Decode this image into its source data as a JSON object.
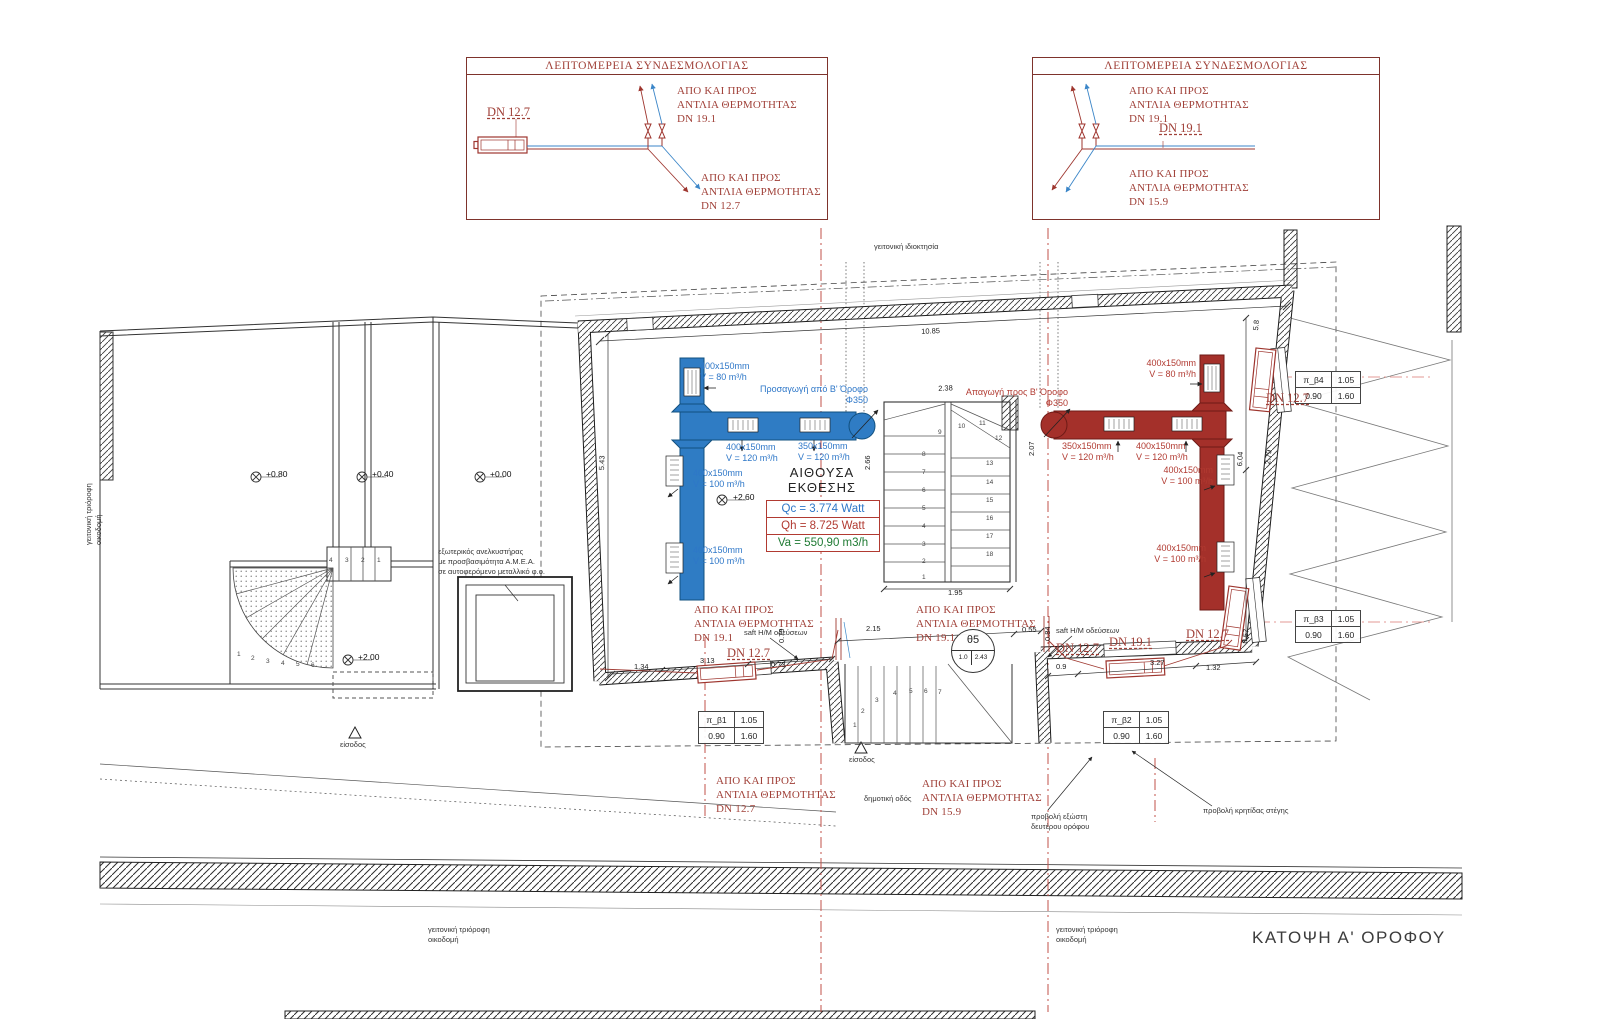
{
  "title": "ΚΑΤΟΨΗ Α' ΟΡΟΦΟΥ",
  "detail_left": {
    "title": "ΛΕΠΤΟΜΕΡΕΙΑ ΣΥΝΔΕΣΜΟΛΟΓΙΑΣ",
    "top_label": "ΑΠΟ ΚΑΙ ΠΡΟΣ\nΑΝΤΛΙΑ ΘΕΡΜΟΤΗΤΑΣ\nDN 19.1",
    "bottom_label": "ΑΠΟ ΚΑΙ ΠΡΟΣ\nΑΝΤΛΙΑ ΘΕΡΜΟΤΗΤΑΣ\nDN 12.7"
  },
  "detail_right": {
    "title": "ΛΕΠΤΟΜΕΡΕΙΑ ΣΥΝΔΕΣΜΟΛΟΓΙΑΣ",
    "top_label": "ΑΠΟ ΚΑΙ ΠΡΟΣ\nΑΝΤΛΙΑ ΘΕΡΜΟΤΗΤΑΣ\nDN 19.1",
    "bottom_label": "ΑΠΟ ΚΑΙ ΠΡΟΣ\n ΑΝΤΛΙΑ ΘΕΡΜΟΤΗΤΑΣ\nDN 15.9"
  },
  "room": {
    "name": "ΑΙΘΟΥΣΑ\nΕΚΘΕΣΗΣ",
    "qc": "Qc = 3.774 Watt",
    "qh": "Qh = 8.725 Watt",
    "va": "Va = 550,90 m3/h"
  },
  "tags": {
    "pb1": {
      "name": "π_β1",
      "w": "1.05",
      "h1": "0.90",
      "h2": "1.60"
    },
    "pb2": {
      "name": "π_β2",
      "w": "1.05",
      "h1": "0.90",
      "h2": "1.60"
    },
    "pb3": {
      "name": "π_β3",
      "w": "1.05",
      "h1": "0.90",
      "h2": "1.60"
    },
    "pb4": {
      "name": "π_β4",
      "w": "1.05",
      "h1": "0.90",
      "h2": "1.60"
    },
    "theta": {
      "name": "θ5",
      "a": "1.0",
      "b": "2.43"
    }
  },
  "colors": {
    "supply_duct": "#2F7CC4",
    "return_duct": "#A4302A",
    "pipe_red": "#9E352E",
    "pipe_blue": "#3B86C8",
    "annotation_red": "#A04038",
    "centerline_red": "#C2514A"
  },
  "annotations": [
    {
      "n": "detail-left-dn",
      "t": "DN 12.7",
      "x": 487,
      "y": 106,
      "cls": "rtxt2"
    },
    {
      "n": "detail-right-dn",
      "t": "DN 19.1",
      "x": 1159,
      "y": 122,
      "cls": "rtxt2"
    },
    {
      "n": "duct-supply-branch-80",
      "t": "400x150mm\nV = 80 m³/h",
      "x": 700,
      "y": 361,
      "cls": "btxt"
    },
    {
      "n": "duct-supply-riser",
      "t": "Προσαγωγή από Β' Όροφο\nΦ350",
      "x": 750,
      "y": 384,
      "cls": "btxt ra",
      "w": 118
    },
    {
      "n": "duct-supply-120a",
      "t": "400x150mm\nV = 120 m³/h",
      "x": 726,
      "y": 442,
      "cls": "btxt"
    },
    {
      "n": "duct-supply-120b",
      "t": "350x150mm\nV = 120 m³/h",
      "x": 798,
      "y": 441,
      "cls": "btxt"
    },
    {
      "n": "duct-supply-100a",
      "t": "400x150mm\nV = 100 m³/h",
      "x": 693,
      "y": 468,
      "cls": "btxt"
    },
    {
      "n": "duct-supply-100b",
      "t": "400x150mm\nV = 100 m³/h",
      "x": 693,
      "y": 545,
      "cls": "btxt"
    },
    {
      "n": "duct-return-branch-80",
      "t": "400x150mm\nV = 80 m³/h",
      "x": 1128,
      "y": 358,
      "cls": "rdtxt ra",
      "w": 68
    },
    {
      "n": "duct-return-riser",
      "t": "Απαγωγή προς Β' Όροφο\nΦ350",
      "x": 950,
      "y": 387,
      "cls": "rdtxt ra",
      "w": 118
    },
    {
      "n": "duct-return-120a",
      "t": "350x150mm\nV = 120 m³/h",
      "x": 1062,
      "y": 441,
      "cls": "rdtxt"
    },
    {
      "n": "duct-return-120b",
      "t": "400x150mm\nV = 120 m³/h",
      "x": 1136,
      "y": 441,
      "cls": "rdtxt"
    },
    {
      "n": "duct-return-100a",
      "t": "400x150mm\nV = 100 m³/h",
      "x": 1145,
      "y": 465,
      "cls": "rdtxt ra",
      "w": 68
    },
    {
      "n": "duct-return-100b",
      "t": "400x150mm\nV = 100 m³/h",
      "x": 1138,
      "y": 543,
      "cls": "rdtxt ra",
      "w": 68
    },
    {
      "n": "hp-label-inside-left",
      "t": "ΑΠΟ ΚΑΙ ΠΡΟΣ\nΑΝΤΛΙΑ ΘΕΡΜΟΤΗΤΑΣ\nDN 19.1",
      "x": 694,
      "y": 604,
      "cls": "rtxt"
    },
    {
      "n": "hp-label-inside-right",
      "t": "ΑΠΟ ΚΑΙ ΠΡΟΣ\nΑΝΤΛΙΑ ΘΕΡΜΟΤΗΤΑΣ\nDN 19.1",
      "x": 916,
      "y": 604,
      "cls": "rtxt"
    },
    {
      "n": "hp-label-outside-left",
      "t": "ΑΠΟ ΚΑΙ ΠΡΟΣ\nΑΝΤΛΙΑ ΘΕΡΜΟΤΗΤΑΣ\nDN 12.7",
      "x": 716,
      "y": 775,
      "cls": "rtxt"
    },
    {
      "n": "hp-label-outside-right",
      "t": "ΑΠΟ ΚΑΙ ΠΡΟΣ\nΑΝΤΛΙΑ ΘΕΡΜΟΤΗΤΑΣ\nDN 15.9",
      "x": 922,
      "y": 778,
      "cls": "rtxt"
    },
    {
      "n": "dn-tag-1",
      "t": "DN 12.7",
      "x": 727,
      "y": 647,
      "cls": "rtxt2"
    },
    {
      "n": "dn-tag-2",
      "t": "DN 12.7",
      "x": 1056,
      "y": 642,
      "cls": "rtxt2"
    },
    {
      "n": "dn-tag-3",
      "t": "DN 19.1",
      "x": 1109,
      "y": 636,
      "cls": "rtxt2"
    },
    {
      "n": "dn-tag-4",
      "t": "DN 12.7",
      "x": 1186,
      "y": 628,
      "cls": "rtxt2"
    },
    {
      "n": "dn-tag-5",
      "t": "DN 12.7",
      "x": 1266,
      "y": 392,
      "cls": "rtxt2"
    },
    {
      "n": "shaft-label-left",
      "t": "saft H/M οδεύσεων",
      "x": 744,
      "y": 628,
      "cls": "ktxt"
    },
    {
      "n": "shaft-label-right",
      "t": "saft H/M οδεύσεων",
      "x": 1056,
      "y": 626,
      "cls": "ktxt"
    },
    {
      "n": "site-neighbor-property",
      "t": "γειτονική ιδιοκτησία",
      "x": 874,
      "y": 242,
      "cls": "ktxt"
    },
    {
      "n": "site-municipal-road",
      "t": "δημοτική οδός",
      "x": 864,
      "y": 794,
      "cls": "ktxt"
    },
    {
      "n": "entrance-label-main",
      "t": "είσοδος",
      "x": 849,
      "y": 755,
      "cls": "ktxt"
    },
    {
      "n": "entrance-label-left",
      "t": "είσοδος",
      "x": 340,
      "y": 740,
      "cls": "ktxt"
    },
    {
      "n": "projection-balcony",
      "t": "προβολή εξώστη\nδευτέρου ορόφου",
      "x": 1031,
      "y": 812,
      "cls": "ktxt"
    },
    {
      "n": "projection-roof",
      "t": "προβολή κρητίδας στέγης",
      "x": 1203,
      "y": 806,
      "cls": "ktxt"
    },
    {
      "n": "neighbor-building-bottom-left",
      "t": "γειτονική τριόροφη\nοικοδομή",
      "x": 428,
      "y": 925,
      "cls": "ktxt"
    },
    {
      "n": "neighbor-building-bottom-center",
      "t": "γειτονική τριόροφη\nοικοδομή",
      "x": 1056,
      "y": 925,
      "cls": "ktxt"
    },
    {
      "n": "neighbor-building-left",
      "t": "γειτονική τριόροφη\nοικοδομή",
      "x": 84,
      "y": 545,
      "cls": "ktxt",
      "r": -90
    },
    {
      "n": "lift-note",
      "t": "εξωτερικός ανελκυστήρας\nμε προσβασιμότητα Α.Μ.Ε.Α.\nσε αυτοφερόμενο μεταλλικό φ.ο.",
      "x": 438,
      "y": 547,
      "cls": "ktxt"
    },
    {
      "n": "level-080",
      "t": "+0.80",
      "x": 266,
      "y": 470,
      "cls": "lvl"
    },
    {
      "n": "level-040",
      "t": "+0.40",
      "x": 372,
      "y": 470,
      "cls": "lvl"
    },
    {
      "n": "level-000",
      "t": "+0.00",
      "x": 490,
      "y": 470,
      "cls": "lvl"
    },
    {
      "n": "level-200",
      "t": "+2.00",
      "x": 358,
      "y": 653,
      "cls": "lvl"
    },
    {
      "n": "level-260",
      "t": "+2.60",
      "x": 733,
      "y": 493,
      "cls": "lvl"
    },
    {
      "n": "dim-1085",
      "t": "10.85",
      "x": 921,
      "y": 328,
      "cls": "dim",
      "r": -3
    },
    {
      "n": "dim-238",
      "t": "2.38",
      "x": 938,
      "y": 385,
      "cls": "dim",
      "r": -3
    },
    {
      "n": "dim-195",
      "t": "1.95",
      "x": 948,
      "y": 589,
      "cls": "dim"
    },
    {
      "n": "dim-215",
      "t": "2.15",
      "x": 866,
      "y": 625,
      "cls": "dim"
    },
    {
      "n": "dim-055",
      "t": "0.55",
      "x": 1022,
      "y": 626,
      "cls": "dim"
    },
    {
      "n": "dim-313",
      "t": "3.13",
      "x": 700,
      "y": 657,
      "cls": "dim"
    },
    {
      "n": "dim-134",
      "t": "1.34",
      "x": 634,
      "y": 663,
      "cls": "dim"
    },
    {
      "n": "dim-073",
      "t": "0.73",
      "x": 771,
      "y": 661,
      "cls": "dim"
    },
    {
      "n": "dim-09",
      "t": "0.9",
      "x": 1056,
      "y": 663,
      "cls": "dim"
    },
    {
      "n": "dim-327",
      "t": "3.27",
      "x": 1150,
      "y": 659,
      "cls": "dim"
    },
    {
      "n": "dim-132",
      "t": "1.32",
      "x": 1206,
      "y": 664,
      "cls": "dim"
    },
    {
      "n": "dim-057",
      "t": "0.57",
      "x": 1241,
      "y": 643,
      "cls": "dim",
      "r": -83
    },
    {
      "n": "dim-266",
      "t": "2.66",
      "x": 864,
      "y": 470,
      "cls": "dim",
      "r": -90
    },
    {
      "n": "dim-207",
      "t": "2.07",
      "x": 1028,
      "y": 456,
      "cls": "dim",
      "r": -90
    },
    {
      "n": "dim-604",
      "t": "6.04",
      "x": 1236,
      "y": 466,
      "cls": "dim",
      "r": -86
    },
    {
      "n": "dim-279",
      "t": "2.79",
      "x": 1264,
      "y": 464,
      "cls": "dim",
      "r": -84
    },
    {
      "n": "dim-543",
      "t": "5.43",
      "x": 598,
      "y": 470,
      "cls": "dim",
      "r": -88
    },
    {
      "n": "dim-58",
      "t": "5.8",
      "x": 1252,
      "y": 330,
      "cls": "dim",
      "r": -84
    },
    {
      "n": "dim-084",
      "t": "0.84",
      "x": 1044,
      "y": 641,
      "cls": "dim",
      "r": -90
    },
    {
      "n": "dim-079",
      "t": "0.79",
      "x": 778,
      "y": 643,
      "cls": "dim",
      "r": -90
    },
    {
      "n": "stair-num",
      "t": "8",
      "x": 922,
      "y": 452,
      "cls": "snum"
    },
    {
      "n": "stair-num",
      "t": "7",
      "x": 922,
      "y": 470,
      "cls": "snum"
    },
    {
      "n": "stair-num",
      "t": "6",
      "x": 922,
      "y": 488,
      "cls": "snum"
    },
    {
      "n": "stair-num",
      "t": "5",
      "x": 922,
      "y": 506,
      "cls": "snum"
    },
    {
      "n": "stair-num",
      "t": "4",
      "x": 922,
      "y": 524,
      "cls": "snum"
    },
    {
      "n": "stair-num",
      "t": "3",
      "x": 922,
      "y": 542,
      "cls": "snum"
    },
    {
      "n": "stair-num",
      "t": "2",
      "x": 922,
      "y": 559,
      "cls": "snum"
    },
    {
      "n": "stair-num",
      "t": "1",
      "x": 922,
      "y": 575,
      "cls": "snum"
    },
    {
      "n": "stair-num",
      "t": "9",
      "x": 938,
      "y": 430,
      "cls": "snum"
    },
    {
      "n": "stair-num",
      "t": "10",
      "x": 958,
      "y": 424,
      "cls": "snum"
    },
    {
      "n": "stair-num",
      "t": "11",
      "x": 979,
      "y": 421,
      "cls": "snum"
    },
    {
      "n": "stair-num",
      "t": "12",
      "x": 995,
      "y": 436,
      "cls": "snum"
    },
    {
      "n": "stair-num",
      "t": "13",
      "x": 986,
      "y": 461,
      "cls": "snum"
    },
    {
      "n": "stair-num",
      "t": "14",
      "x": 986,
      "y": 480,
      "cls": "snum"
    },
    {
      "n": "stair-num",
      "t": "15",
      "x": 986,
      "y": 498,
      "cls": "snum"
    },
    {
      "n": "stair-num",
      "t": "16",
      "x": 986,
      "y": 516,
      "cls": "snum"
    },
    {
      "n": "stair-num",
      "t": "17",
      "x": 986,
      "y": 534,
      "cls": "snum"
    },
    {
      "n": "stair-num",
      "t": "18",
      "x": 986,
      "y": 552,
      "cls": "snum"
    },
    {
      "n": "stair-num",
      "t": "1",
      "x": 853,
      "y": 723,
      "cls": "snum"
    },
    {
      "n": "stair-num",
      "t": "2",
      "x": 861,
      "y": 709,
      "cls": "snum"
    },
    {
      "n": "stair-num",
      "t": "3",
      "x": 875,
      "y": 698,
      "cls": "snum"
    },
    {
      "n": "stair-num",
      "t": "4",
      "x": 893,
      "y": 691,
      "cls": "snum"
    },
    {
      "n": "stair-num",
      "t": "5",
      "x": 909,
      "y": 689,
      "cls": "snum"
    },
    {
      "n": "stair-num",
      "t": "6",
      "x": 924,
      "y": 689,
      "cls": "snum"
    },
    {
      "n": "stair-num",
      "t": "7",
      "x": 938,
      "y": 690,
      "cls": "snum"
    },
    {
      "n": "stair-num",
      "t": "1",
      "x": 237,
      "y": 652,
      "cls": "snum"
    },
    {
      "n": "stair-num",
      "t": "2",
      "x": 251,
      "y": 656,
      "cls": "snum"
    },
    {
      "n": "stair-num",
      "t": "3",
      "x": 266,
      "y": 659,
      "cls": "snum"
    },
    {
      "n": "stair-num",
      "t": "4",
      "x": 281,
      "y": 661,
      "cls": "snum"
    },
    {
      "n": "stair-num",
      "t": "5",
      "x": 296,
      "y": 662,
      "cls": "snum"
    },
    {
      "n": "stair-num",
      "t": "6",
      "x": 311,
      "y": 663,
      "cls": "snum"
    },
    {
      "n": "stair-num",
      "t": "4",
      "x": 329,
      "y": 558,
      "cls": "snum"
    },
    {
      "n": "stair-num",
      "t": "3",
      "x": 345,
      "y": 558,
      "cls": "snum"
    },
    {
      "n": "stair-num",
      "t": "2",
      "x": 361,
      "y": 558,
      "cls": "snum"
    },
    {
      "n": "stair-num",
      "t": "1",
      "x": 377,
      "y": 558,
      "cls": "snum"
    }
  ]
}
